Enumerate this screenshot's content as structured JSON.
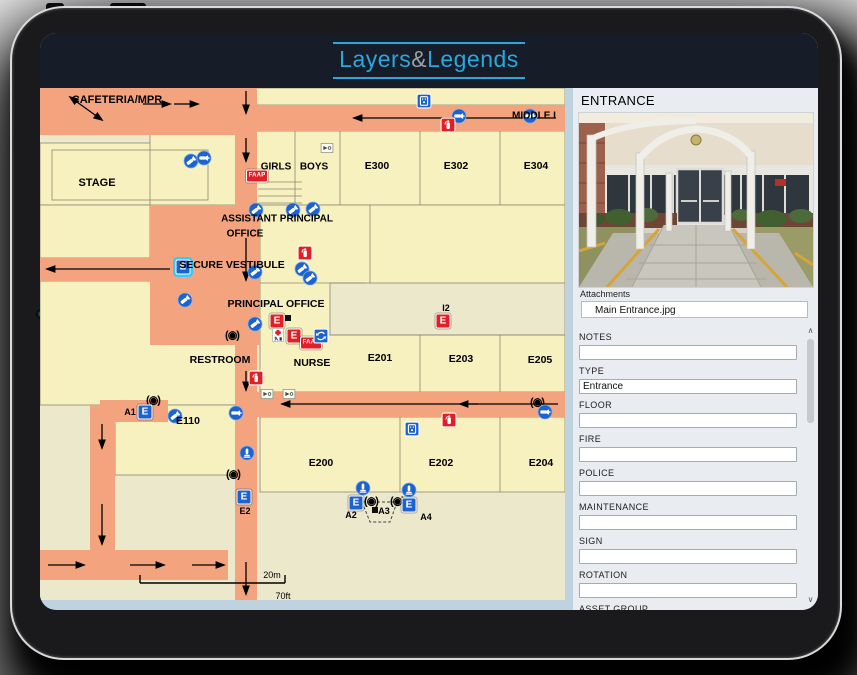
{
  "app": {
    "logo": {
      "part1": "Layers",
      "amp": "&",
      "part2": "Legends"
    }
  },
  "colors": {
    "accent_blue": "#2ba7dd",
    "topbar": "#171d28",
    "corridor": "#f3a47f",
    "room": "#f7f0bf",
    "outside": "#ece8cc",
    "icon_blue": "#1d62cd",
    "icon_red": "#e01f26",
    "selection_cyan": "#35c8f2",
    "panel_bg": "#e9ecf0"
  },
  "map": {
    "labels": [
      {
        "t": "CAFETERIA/MPR",
        "x": 77,
        "y": 12,
        "s": 11
      },
      {
        "t": "STAGE",
        "x": 57,
        "y": 95,
        "s": 11
      },
      {
        "t": "GIRLS",
        "x": 236,
        "y": 79,
        "s": 10
      },
      {
        "t": "BOYS",
        "x": 274,
        "y": 79,
        "s": 10
      },
      {
        "t": "E300",
        "x": 337,
        "y": 78,
        "s": 10.5
      },
      {
        "t": "E302",
        "x": 416,
        "y": 78,
        "s": 10.5
      },
      {
        "t": "E304",
        "x": 496,
        "y": 78,
        "s": 10.5
      },
      {
        "t": "MIDDLE I",
        "x": 494,
        "y": 28,
        "s": 10
      },
      {
        "t": "ASSISTANT PRINCIPAL",
        "x": 237,
        "y": 131,
        "s": 10
      },
      {
        "t": "OFFICE",
        "x": 205,
        "y": 146,
        "s": 10
      },
      {
        "t": "SECURE VESTIBULE",
        "x": 192,
        "y": 177,
        "s": 10.5
      },
      {
        "t": "PRINCIPAL OFFICE",
        "x": 236,
        "y": 216,
        "s": 10.5
      },
      {
        "t": "I2",
        "x": 406,
        "y": 220,
        "s": 9
      },
      {
        "t": "RESTROOM",
        "x": 180,
        "y": 272,
        "s": 10.5
      },
      {
        "t": "NURSE",
        "x": 272,
        "y": 275,
        "s": 10.5
      },
      {
        "t": "E201",
        "x": 340,
        "y": 270,
        "s": 10.5
      },
      {
        "t": "E203",
        "x": 421,
        "y": 271,
        "s": 10.5
      },
      {
        "t": "E205",
        "x": 500,
        "y": 272,
        "s": 10.5
      },
      {
        "t": "A1",
        "x": 90,
        "y": 324,
        "s": 9
      },
      {
        "t": "E110",
        "x": 148,
        "y": 333,
        "s": 10.5
      },
      {
        "t": "E200",
        "x": 281,
        "y": 375,
        "s": 10.5
      },
      {
        "t": "E202",
        "x": 401,
        "y": 375,
        "s": 10.5
      },
      {
        "t": "E204",
        "x": 501,
        "y": 375,
        "s": 10.5
      },
      {
        "t": "E2",
        "x": 205,
        "y": 423,
        "s": 9
      },
      {
        "t": "A2",
        "x": 311,
        "y": 427,
        "s": 9
      },
      {
        "t": "A3",
        "x": 344,
        "y": 423,
        "s": 9
      },
      {
        "t": "A4",
        "x": 386,
        "y": 429,
        "s": 9
      },
      {
        "t": "20m",
        "x": 232,
        "y": 487,
        "s": 9,
        "w": "n"
      },
      {
        "t": "70ft",
        "x": 243,
        "y": 508,
        "s": 9,
        "w": "n"
      }
    ],
    "icons": [
      {
        "k": "cam",
        "x": 151,
        "y": 73
      },
      {
        "k": "horn",
        "x": 164,
        "y": 70
      },
      {
        "k": "faap",
        "t": "FAAP",
        "x": 217,
        "y": 88
      },
      {
        "k": "cam",
        "x": 216,
        "y": 122
      },
      {
        "k": "cam",
        "x": 253,
        "y": 122
      },
      {
        "k": "cam",
        "x": 273,
        "y": 121
      },
      {
        "k": "whitebox",
        "x": 287,
        "y": 60
      },
      {
        "k": "aed",
        "x": 384,
        "y": 13
      },
      {
        "k": "horn",
        "x": 419,
        "y": 28
      },
      {
        "k": "ext",
        "x": 408,
        "y": 37
      },
      {
        "k": "horn",
        "x": 490,
        "y": 28
      },
      {
        "k": "exit",
        "c": "blue",
        "t": "E",
        "x": 143,
        "y": 179,
        "sel": true
      },
      {
        "k": "cam",
        "x": 145,
        "y": 212
      },
      {
        "k": "ext",
        "x": 265,
        "y": 165
      },
      {
        "k": "cam",
        "x": 215,
        "y": 184
      },
      {
        "k": "cam",
        "x": 262,
        "y": 181
      },
      {
        "k": "cam",
        "x": 270,
        "y": 190
      },
      {
        "k": "dome",
        "x": 192,
        "y": 247
      },
      {
        "k": "cam",
        "x": 215,
        "y": 236
      },
      {
        "k": "exit",
        "c": "red",
        "t": "E",
        "x": 237,
        "y": 233
      },
      {
        "k": "blacksq",
        "x": 248,
        "y": 230
      },
      {
        "k": "firstaid",
        "x": 238,
        "y": 247
      },
      {
        "k": "exit",
        "c": "red",
        "t": "E",
        "x": 254,
        "y": 248
      },
      {
        "k": "faap",
        "t": "FAAP",
        "x": 271,
        "y": 255
      },
      {
        "k": "rotate",
        "x": 281,
        "y": 248
      },
      {
        "k": "exit",
        "c": "red",
        "t": "E",
        "x": 403,
        "y": 233
      },
      {
        "k": "ext",
        "x": 216,
        "y": 290
      },
      {
        "k": "dome",
        "x": 113,
        "y": 312
      },
      {
        "k": "exit",
        "c": "blue",
        "t": "E",
        "x": 105,
        "y": 324
      },
      {
        "k": "cam",
        "x": 135,
        "y": 328
      },
      {
        "k": "horn",
        "x": 196,
        "y": 325
      },
      {
        "k": "whitebox",
        "x": 227,
        "y": 306
      },
      {
        "k": "whitebox",
        "x": 249,
        "y": 306
      },
      {
        "k": "dome",
        "x": 497,
        "y": 314
      },
      {
        "k": "horn",
        "x": 505,
        "y": 324
      },
      {
        "k": "aed",
        "x": 372,
        "y": 341
      },
      {
        "k": "ext",
        "x": 409,
        "y": 332
      },
      {
        "k": "alarm",
        "x": 207,
        "y": 365
      },
      {
        "k": "dome",
        "x": 193,
        "y": 386
      },
      {
        "k": "exit",
        "c": "blue",
        "t": "E",
        "x": 204,
        "y": 409
      },
      {
        "k": "alarm",
        "x": 323,
        "y": 400
      },
      {
        "k": "exit",
        "c": "blue",
        "t": "E",
        "x": 316,
        "y": 415
      },
      {
        "k": "dome",
        "x": 331,
        "y": 413
      },
      {
        "k": "dome",
        "x": 357,
        "y": 413
      },
      {
        "k": "exit",
        "c": "blue",
        "t": "E",
        "x": 369,
        "y": 417
      },
      {
        "k": "alarm",
        "x": 369,
        "y": 402
      },
      {
        "k": "blacksq",
        "x": 335,
        "y": 422
      }
    ]
  },
  "panel": {
    "title": "ENTRANCE",
    "attachments_label": "Attachments",
    "attachments": [
      "Main Entrance.jpg"
    ],
    "fields": [
      {
        "label": "NOTES",
        "value": ""
      },
      {
        "label": "TYPE",
        "value": "Entrance"
      },
      {
        "label": "FLOOR",
        "value": ""
      },
      {
        "label": "FIRE",
        "value": ""
      },
      {
        "label": "POLICE",
        "value": ""
      },
      {
        "label": "MAINTENANCE",
        "value": ""
      },
      {
        "label": "SIGN",
        "value": ""
      },
      {
        "label": "ROTATION",
        "value": ""
      },
      {
        "label": "ASSET GROUP",
        "value": ""
      }
    ],
    "scrollbar": {
      "up": "∧",
      "down": "∨"
    }
  }
}
